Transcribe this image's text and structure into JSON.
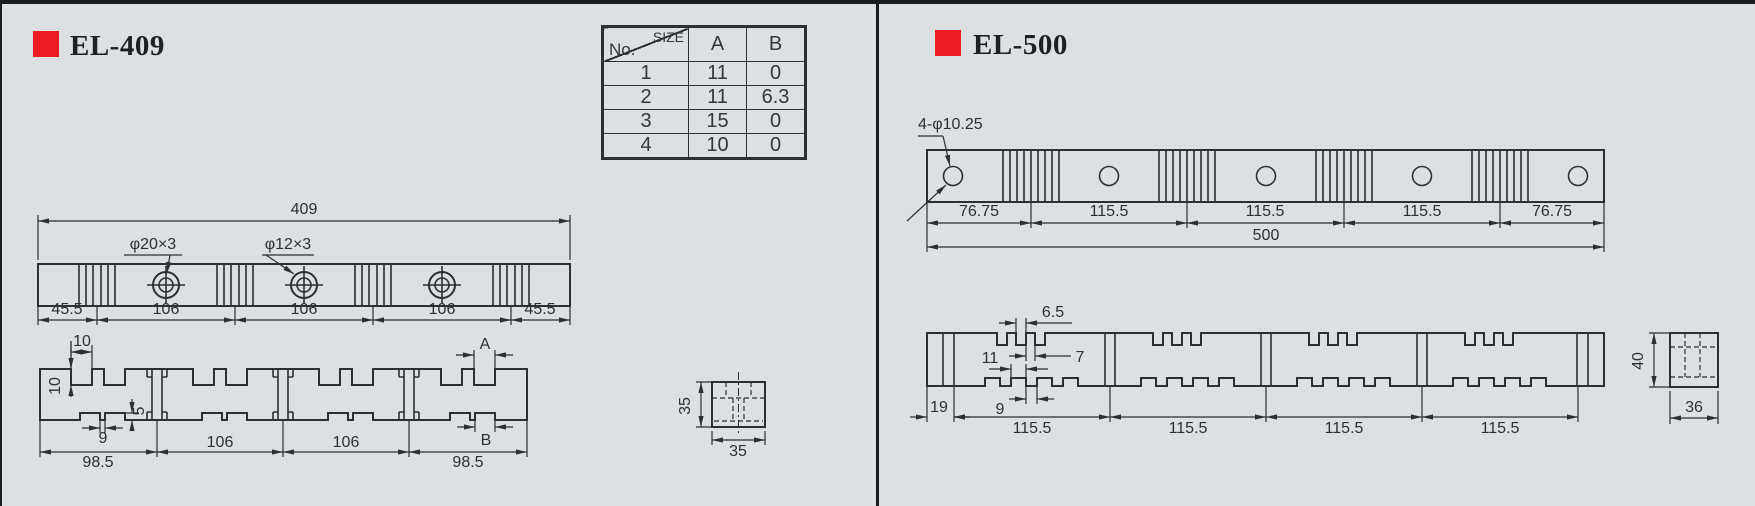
{
  "background_color": "#dce0e3",
  "accent_color": "#ec1b24",
  "panels": {
    "el409": {
      "title": "EL-409",
      "size_table": {
        "corner_top": "SIZE",
        "corner_bottom": "No.",
        "col_a": "A",
        "col_b": "B",
        "rows": [
          {
            "no": "1",
            "a": "11",
            "b": "0"
          },
          {
            "no": "2",
            "a": "11",
            "b": "6.3"
          },
          {
            "no": "3",
            "a": "15",
            "b": "0"
          },
          {
            "no": "4",
            "a": "10",
            "b": "0"
          }
        ]
      },
      "top_view": {
        "overall_length": "409",
        "callout_large_holes": "φ20×3",
        "callout_small_holes": "φ12×3",
        "segment_dims": [
          "45.5",
          "106",
          "106",
          "106",
          "45.5"
        ]
      },
      "side_view": {
        "notch_width": "10",
        "notch_depth": "10",
        "bottom_notch_depth": "5",
        "bottom_notch_gap": "9",
        "ref_a": "A",
        "ref_b": "B",
        "segment_dims": [
          "98.5",
          "106",
          "106",
          "98.5"
        ]
      },
      "section_view": {
        "height": "35",
        "width": "35"
      }
    },
    "el500": {
      "title": "EL-500",
      "hole_callout": "4-φ10.25",
      "top_view": {
        "segment_dims": [
          "76.75",
          "115.5",
          "115.5",
          "115.5",
          "76.75"
        ],
        "overall_length": "500"
      },
      "side_view": {
        "top_notch_width": "6.5",
        "top_tooth_width": "7",
        "bottom_notch_width": "11",
        "bottom_tooth_width": "9",
        "end_width": "19",
        "segment_dims": [
          "115.5",
          "115.5",
          "115.5",
          "115.5"
        ]
      },
      "section_view": {
        "height": "40",
        "width": "36"
      }
    }
  }
}
